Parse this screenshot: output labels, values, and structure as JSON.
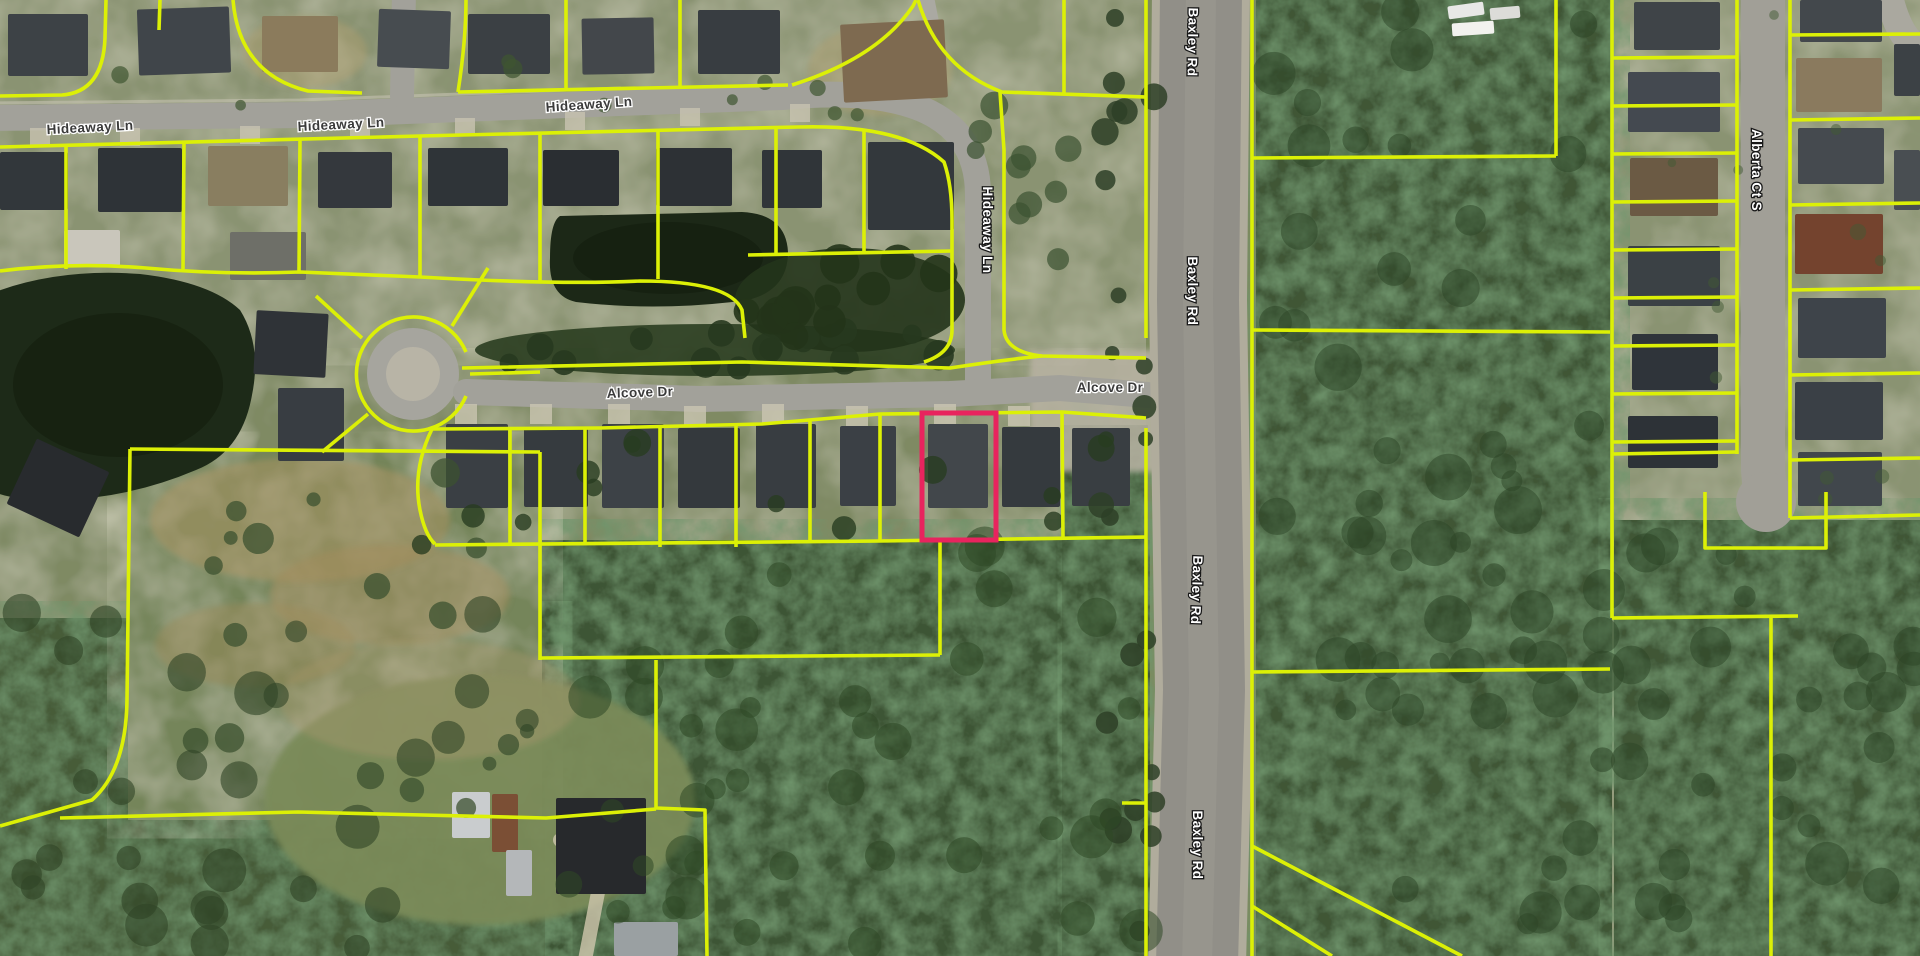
{
  "map": {
    "type": "satellite-parcel-view",
    "description": "Aerial parcel map with lot boundaries and one selected parcel",
    "road_labels": [
      {
        "id": "hideaway-ln-1",
        "text": "Hideaway Ln",
        "x": 90,
        "y": 127,
        "rot": -3,
        "style": "minor"
      },
      {
        "id": "hideaway-ln-2",
        "text": "Hideaway Ln",
        "x": 341,
        "y": 124,
        "rot": -3,
        "style": "minor"
      },
      {
        "id": "hideaway-ln-3",
        "text": "Hideaway Ln",
        "x": 589,
        "y": 104,
        "rot": -4,
        "style": "minor"
      },
      {
        "id": "hideaway-ln-vertical",
        "text": "Hideaway Ln",
        "x": 988,
        "y": 230,
        "rot": 90,
        "style": "major"
      },
      {
        "id": "alcove-dr-1",
        "text": "Alcove Dr",
        "x": 640,
        "y": 392,
        "rot": -2,
        "style": "minor"
      },
      {
        "id": "alcove-dr-2",
        "text": "Alcove Dr",
        "x": 1110,
        "y": 387,
        "rot": 0,
        "style": "minor"
      },
      {
        "id": "baxley-rd-1",
        "text": "Baxley Rd",
        "x": 1193,
        "y": 42,
        "rot": 91,
        "style": "major"
      },
      {
        "id": "baxley-rd-2",
        "text": "Baxley Rd",
        "x": 1193,
        "y": 291,
        "rot": 90,
        "style": "major"
      },
      {
        "id": "baxley-rd-3",
        "text": "Baxley Rd",
        "x": 1197,
        "y": 590,
        "rot": 92,
        "style": "major"
      },
      {
        "id": "baxley-rd-4",
        "text": "Baxley Rd",
        "x": 1198,
        "y": 845,
        "rot": 90,
        "style": "major"
      },
      {
        "id": "alberta-ct-s",
        "text": "Alberta Ct S",
        "x": 1757,
        "y": 170,
        "rot": 90,
        "style": "major"
      }
    ],
    "selected_parcel": {
      "x": 922,
      "y": 413,
      "width": 74,
      "height": 127
    },
    "colors": {
      "parcel_line": "#dcf006",
      "selected_outline": "#e8245e",
      "label_dark": "#3b3b3b",
      "label_light": "#ffffff",
      "water": "#1d2a18",
      "forest": "#3f5636",
      "road": "#a2a19a"
    }
  }
}
